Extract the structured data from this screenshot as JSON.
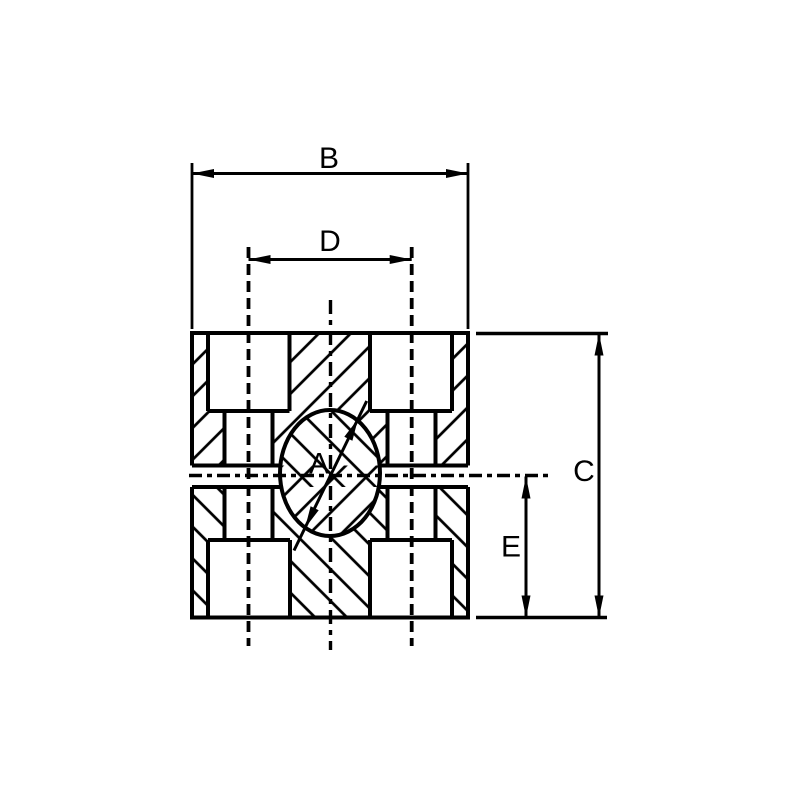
{
  "figure": {
    "kind": "technical-section-drawing",
    "subject": "pipe-clamp-body cross section, two halves with bore and counterbored bolt holes"
  },
  "dimension_labels": {
    "bore_diameter": "A",
    "overall_width": "B",
    "overall_height": "C",
    "bolt_spacing": "D",
    "center_to_bottom": "E"
  },
  "colors": {
    "ink": "#000000",
    "paper": "#ffffff"
  }
}
